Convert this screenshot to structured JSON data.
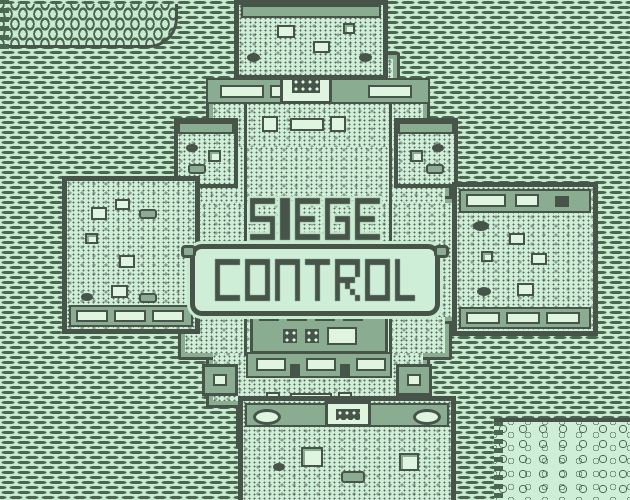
{
  "app": {
    "name": "Siege Control",
    "screen": "title"
  },
  "logo": {
    "line1": "SIEGE",
    "line2": "CONTROL"
  },
  "palette": {
    "light": "#c8ebd0",
    "floor_light": "#cfeed7",
    "panel_light": "#dff5e0",
    "mid_green": "#8aac91",
    "dark_green": "#46544a",
    "dash_green": "#4b6752"
  }
}
